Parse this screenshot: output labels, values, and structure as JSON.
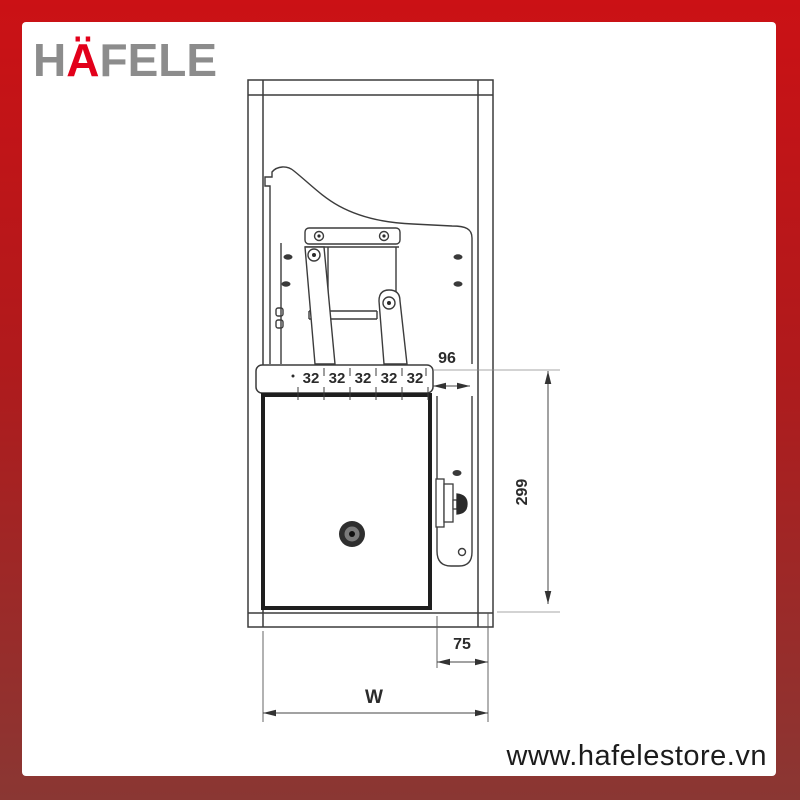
{
  "brand": {
    "logo_prefix": "H",
    "logo_umlaut": "Ä",
    "logo_suffix": "FELE"
  },
  "footer": {
    "website": "www.hafelestore.vn"
  },
  "colors": {
    "brand_red": "#e2001a",
    "logo_gray": "#8c8c8c",
    "frame_gradient_top": "#cb1115",
    "frame_gradient_bottom": "#8a3733",
    "drawing_line": "#3c3c3c"
  },
  "diagram": {
    "type": "technical-drawing",
    "subject": "lift-up cabinet mechanism side view",
    "dimensions": {
      "pitch_segments": [
        "32",
        "32",
        "32",
        "32",
        "32"
      ],
      "dim_96": "96",
      "dim_299": "299",
      "dim_75": "75",
      "dim_w": "W"
    }
  }
}
